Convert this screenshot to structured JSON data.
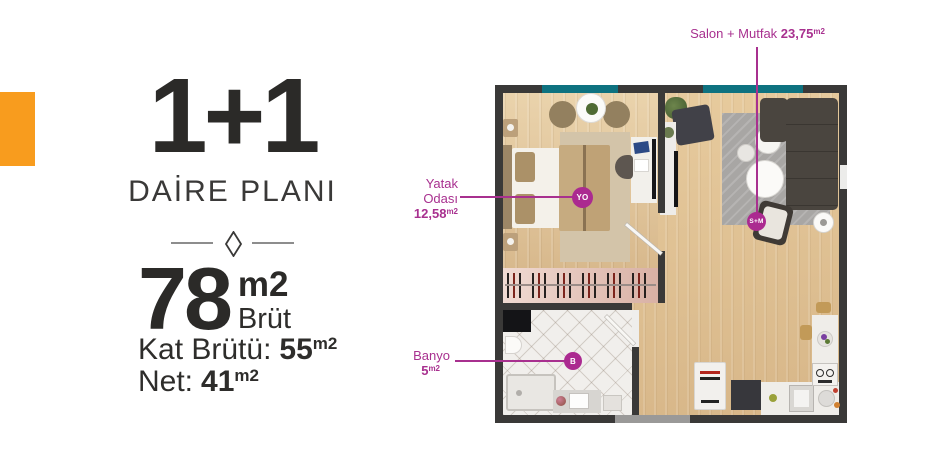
{
  "colors": {
    "accent": "#a8308f",
    "orange": "#f89c1e",
    "window_teal": "#0e7280",
    "wall": "#3a3938",
    "heading_text": "#2b2a28"
  },
  "left_panel": {
    "plan_type": "1+1",
    "plan_label": "DAİRE PLANI",
    "gross": {
      "value": "78",
      "unit": "m2",
      "label": "Brüt"
    },
    "floor_gross": {
      "label": "Kat Brütü:",
      "value": "55",
      "unit": "m2"
    },
    "net": {
      "label": "Net:",
      "value": "41",
      "unit": "m2"
    }
  },
  "floor_plan": {
    "rooms": {
      "salon": {
        "label": "Salon + Mutfak",
        "area": "23,75",
        "unit": "m2",
        "badge": "S+M"
      },
      "yatak": {
        "label_line1": "Yatak",
        "label_line2": "Odası",
        "area": "12,58",
        "unit": "m2",
        "badge": "YO"
      },
      "banyo": {
        "label": "Banyo",
        "area": "5",
        "unit": "m2",
        "badge": "B"
      }
    }
  }
}
